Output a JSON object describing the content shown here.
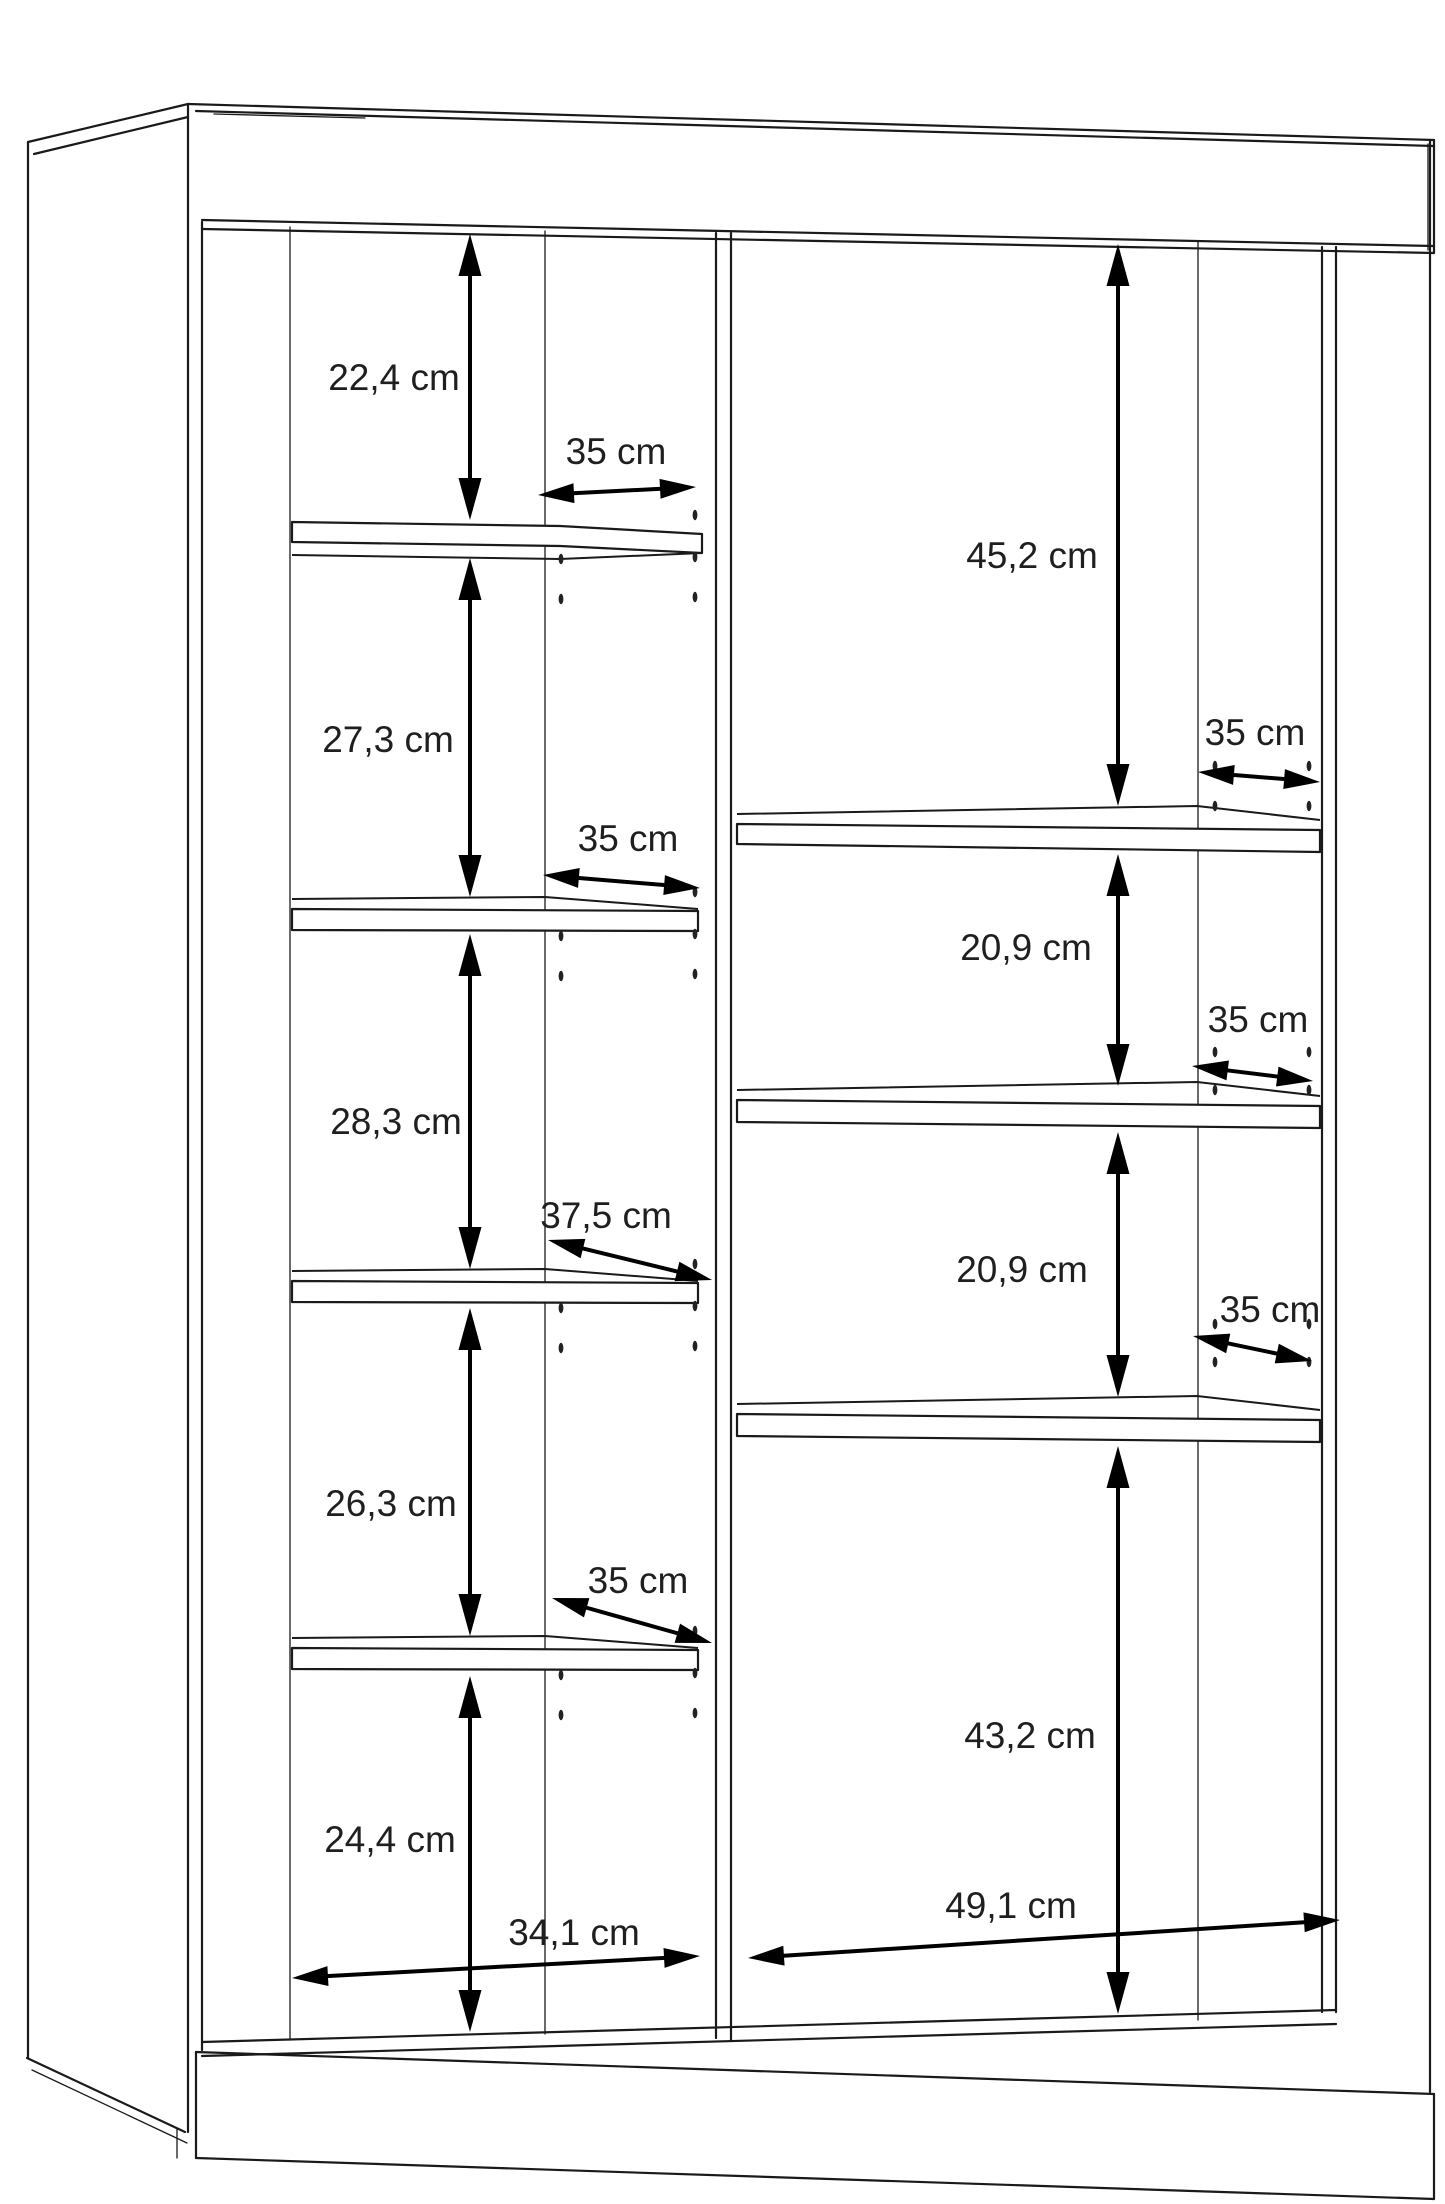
{
  "diagram": {
    "subject": "cabinet dimension drawing",
    "unit": "cm",
    "left_column": {
      "section_heights": [
        "22,4 cm",
        "27,3 cm",
        "28,3 cm",
        "26,3 cm",
        "24,4 cm"
      ],
      "shelf_depths": [
        "35 cm",
        "35 cm",
        "37,5 cm",
        "35 cm"
      ],
      "inner_width": "34,1 cm"
    },
    "right_column": {
      "section_heights": [
        "45,2 cm",
        "20,9 cm",
        "20,9 cm",
        "43,2 cm"
      ],
      "shelf_depths": [
        "35 cm",
        "35 cm",
        "35 cm"
      ],
      "inner_width": "49,1 cm"
    }
  }
}
